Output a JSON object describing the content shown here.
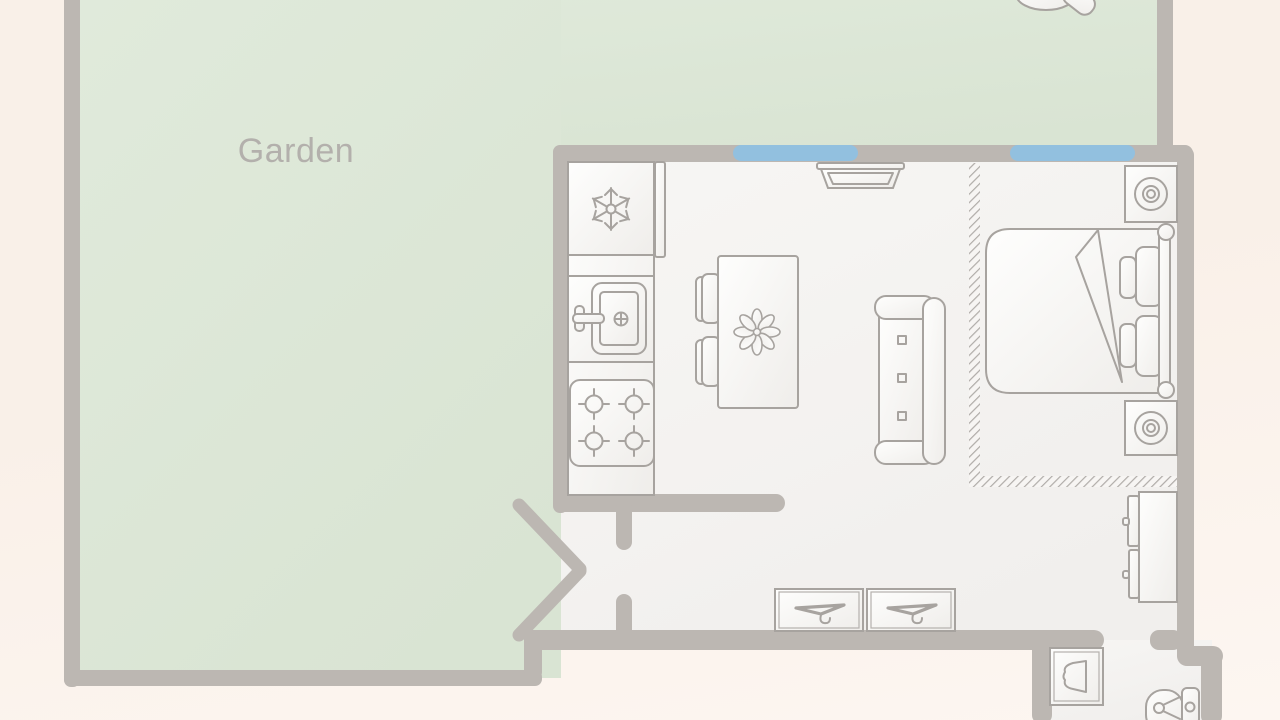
{
  "floorplan": {
    "garden_label": "Garden",
    "colors": {
      "background-top": "#f9f0e8",
      "background-bottom": "#fdf6f1",
      "garden": "#dfe9da",
      "garden-deep": "#d9e4d3",
      "wall": "#bcb7b2",
      "room": "#f7f5f3",
      "room-deep": "#f1efec",
      "window": "#92c0df",
      "furniture-stroke": "#a7a39f",
      "furniture-fill": "#fcfbfa",
      "hatch": "#b0aca8",
      "label": "#b3b0ac"
    },
    "rooms": [
      {
        "name": "garden",
        "label": "Garden"
      },
      {
        "name": "kitchen-living",
        "label": ""
      },
      {
        "name": "bedroom",
        "label": ""
      },
      {
        "name": "hallway",
        "label": ""
      },
      {
        "name": "bathroom",
        "label": ""
      }
    ],
    "openings": {
      "windows": [
        "kitchen-window",
        "bedroom-window"
      ],
      "doors": [
        "garden-double-door",
        "bathroom-doorway"
      ]
    },
    "furniture": [
      "fridge-freezer",
      "kitchen-counter",
      "kitchen-sink",
      "stove",
      "kitchen-island",
      "bar-stool",
      "bar-stool",
      "island-plant",
      "sofa",
      "wall-tv",
      "double-bed",
      "pillows",
      "nightstand-lamp",
      "nightstand-lamp",
      "dresser",
      "wardrobe-hanger-unit",
      "wardrobe-hanger-unit",
      "washbasin",
      "toilet",
      "garden-bush"
    ],
    "icons": [
      "snowflake-icon",
      "burner-icon",
      "faucet-icon",
      "drain-icon",
      "plant-icon",
      "hanger-icon",
      "lamp-icon",
      "basin-icon",
      "toilet-icon"
    ]
  }
}
